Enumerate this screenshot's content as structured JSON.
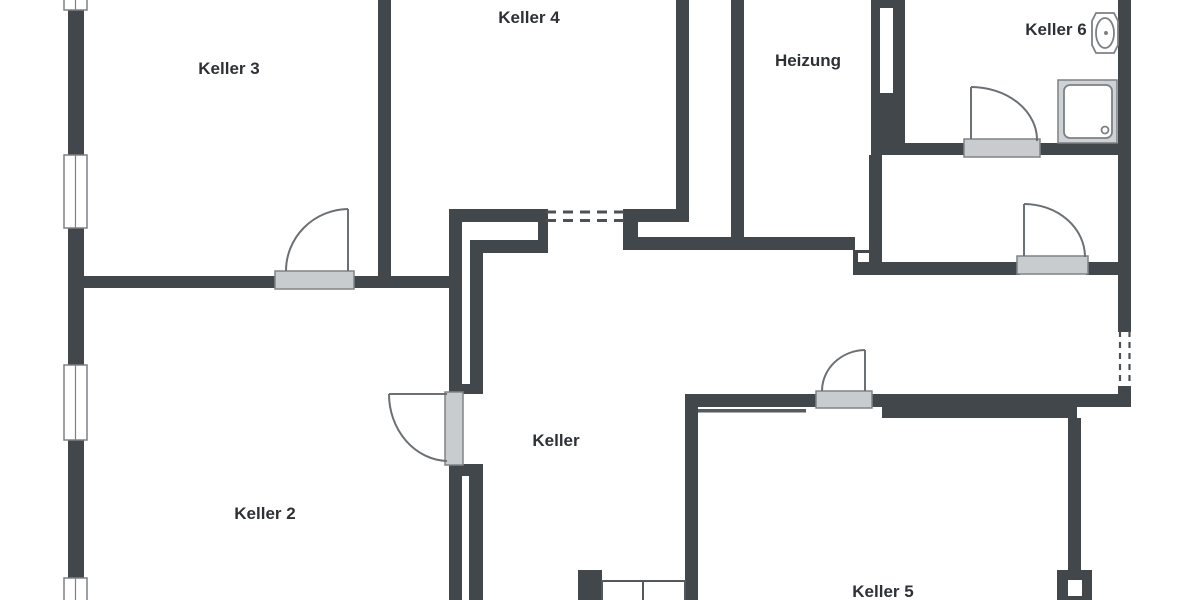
{
  "rooms": [
    {
      "id": "keller-3",
      "label": "Keller 3"
    },
    {
      "id": "keller-4",
      "label": "Keller 4"
    },
    {
      "id": "heizung",
      "label": "Heizung"
    },
    {
      "id": "keller-6",
      "label": "Keller 6"
    },
    {
      "id": "keller",
      "label": "Keller"
    },
    {
      "id": "keller-2",
      "label": "Keller 2"
    },
    {
      "id": "keller-5",
      "label": "Keller 5"
    }
  ],
  "fixtures": {
    "washbasin": "washbasin-icon",
    "shower": "shower-tray-icon",
    "stairs": "stairs-icon",
    "chimney": "chimney-block-icon"
  },
  "colors": {
    "wall_color": "#42474c",
    "threshold_fill": "#c9cccf",
    "threshold_border": "#7f8487",
    "door_line": "#6b7074",
    "window_line": "#7c8185",
    "dash_line": "#4c5156",
    "fixture_line": "#7c8185",
    "text_color": "#2d3135",
    "background": "#ffffff"
  }
}
